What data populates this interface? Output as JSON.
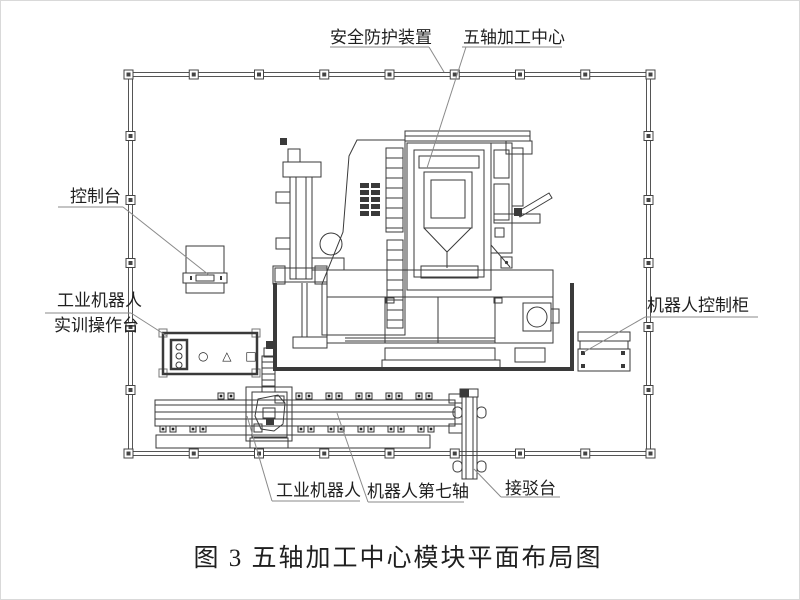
{
  "colors": {
    "background": "#ffffff",
    "line_dark": "#3a3a3a",
    "leader": "#8a8a8a",
    "text": "#1f1f1f",
    "fence": "#555555"
  },
  "caption": "图 3 五轴加工中心模块平面布局图",
  "labels": {
    "safety_guard": "安全防护装置",
    "machining_center": "五轴加工中心",
    "console": "控制台",
    "training_console_line1": "工业机器人",
    "training_console_line2": "实训操作台",
    "robot_cabinet": "机器人控制柜",
    "industrial_robot": "工业机器人",
    "seventh_axis": "机器人第七轴",
    "docking_table": "接驳台",
    "panel_symbols": "○ △ □"
  }
}
